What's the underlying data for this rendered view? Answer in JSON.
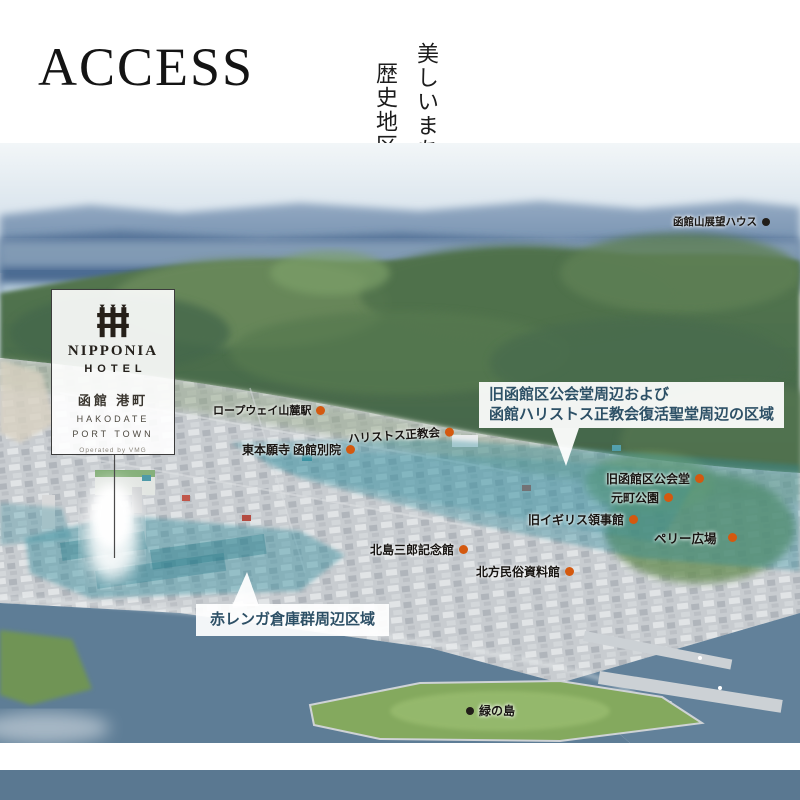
{
  "page": {
    "title": "ACCESS",
    "tagline_line1": "美しいまちなみが広がる",
    "tagline_line2": "歴史地区の中心を旅の拠点に"
  },
  "hotel_card": {
    "logo_icon": "nipponia-gate-icon",
    "brand": "NIPPONIA",
    "brand_sub": "HOTEL",
    "name_jp": "函館 港町",
    "name_en_line1": "HAKODATE",
    "name_en_line2": "PORT TOWN",
    "operator": "Operated by VMG"
  },
  "map": {
    "markers": [
      {
        "label": "函館山展望ハウス",
        "dot": "black"
      },
      {
        "label": "ロープウェイ山麓駅",
        "dot": "orange"
      },
      {
        "label": "ハリストス正教会",
        "dot": "orange"
      },
      {
        "label": "東本願寺 函館別院",
        "dot": "orange"
      },
      {
        "label": "旧函館区公会堂",
        "dot": "orange"
      },
      {
        "label": "元町公園",
        "dot": "orange"
      },
      {
        "label": "旧イギリス領事館",
        "dot": "orange"
      },
      {
        "label": "ペリー広場",
        "dot": "orange"
      },
      {
        "label": "北島三郎記念館",
        "dot": "orange"
      },
      {
        "label": "北方民俗資料館",
        "dot": "orange"
      },
      {
        "label": "緑の島",
        "dot": "black"
      }
    ],
    "callouts": [
      {
        "lines": [
          "旧函館区公会堂周辺および",
          "函館ハリストス正教会復活聖堂周辺の区域"
        ]
      },
      {
        "lines": [
          "赤レンガ倉庫群周辺区域"
        ]
      }
    ],
    "colors": {
      "marker_dot_orange": "#d4590f",
      "marker_dot_black": "#221e19",
      "district_highlight_teal": "#2e8d9e",
      "callout_text": "#2d5066",
      "footer_bar": "#5a7891"
    }
  }
}
